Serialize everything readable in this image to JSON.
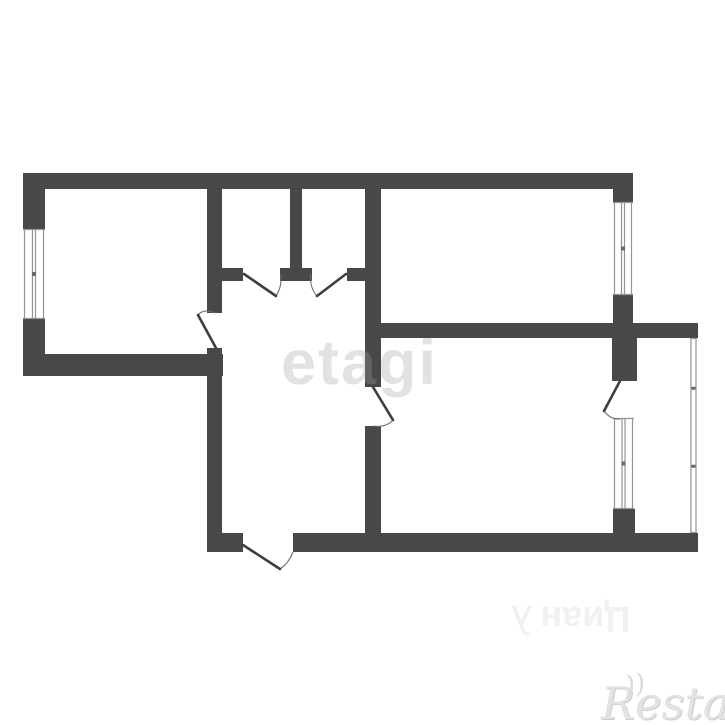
{
  "watermarks": {
    "center": "etagi",
    "bottom_rotated": "Циан",
    "bottom_logo": "λ",
    "corner": "Restate",
    "corner_flourish": "))"
  },
  "plan": {
    "colors": {
      "background": "#ffffff",
      "wall": "#494749",
      "door_line": "#3e3d40",
      "arc_line": "#6f6f6f",
      "window_line": "#949494",
      "window_tick": "#6a6a6a"
    },
    "walls": [
      [
        23,
        173,
        610,
        16
      ],
      [
        23,
        189,
        22,
        40
      ],
      [
        23,
        319,
        22,
        57
      ],
      [
        23,
        354,
        200,
        22
      ],
      [
        207,
        189,
        15,
        124
      ],
      [
        222,
        268,
        21,
        13
      ],
      [
        207,
        348,
        15,
        204
      ],
      [
        207,
        533,
        36,
        19
      ],
      [
        293,
        533,
        405,
        19
      ],
      [
        290,
        189,
        12,
        79
      ],
      [
        280,
        268,
        32,
        13
      ],
      [
        347,
        268,
        19,
        13
      ],
      [
        365,
        189,
        16,
        198
      ],
      [
        365,
        426,
        16,
        126
      ],
      [
        613,
        189,
        20,
        13
      ],
      [
        613,
        295,
        20,
        28
      ],
      [
        365,
        323,
        333,
        15
      ],
      [
        612,
        338,
        25,
        43
      ],
      [
        613,
        509,
        22,
        24
      ]
    ],
    "windows": [
      {
        "x": 23,
        "y": 229,
        "w": 22,
        "h": 90
      },
      {
        "x": 613,
        "y": 202,
        "w": 20,
        "h": 93
      },
      {
        "x": 613,
        "y": 418,
        "w": 21,
        "h": 91
      }
    ],
    "glazing": [
      {
        "x": 690,
        "y": 338,
        "w": 7,
        "h": 195
      }
    ],
    "doors": [
      {
        "leaf": [
          216,
          348,
          198,
          315
        ],
        "arc": "M198,315 Q204,308 215,313"
      },
      {
        "leaf": [
          244,
          274,
          276,
          296
        ],
        "arc": "M281,274 Q282,287 276,296"
      },
      {
        "leaf": [
          346,
          274,
          317,
          296
        ],
        "arc": "M311,274 Q309,287 317,296"
      },
      {
        "leaf": [
          373,
          387,
          393,
          420
        ],
        "arc": "M373,426 Q386,428 393,420"
      },
      {
        "leaf": [
          620,
          381,
          604,
          411
        ],
        "arc": "M620,419 Q611,420 604,411"
      },
      {
        "leaf": [
          243,
          545,
          280,
          569
        ],
        "arc": "M280,569 Q289,563 293,552"
      }
    ]
  }
}
